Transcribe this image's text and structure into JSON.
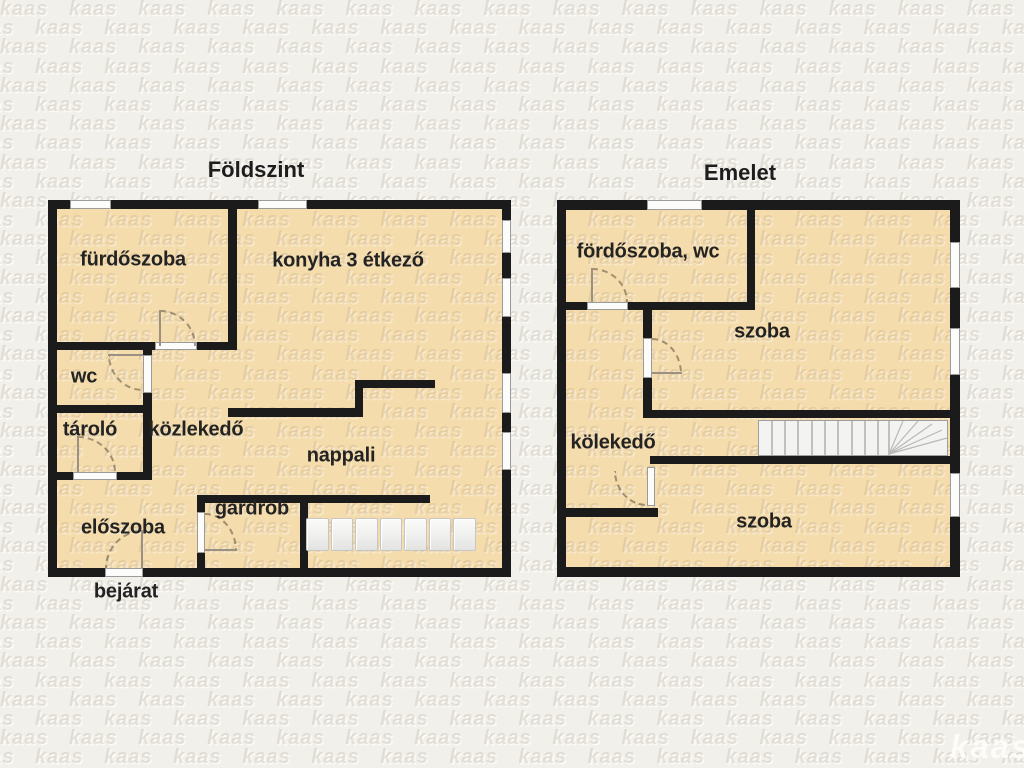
{
  "watermark": {
    "text": "kaas"
  },
  "brand": {
    "logo": "kaas"
  },
  "ground_floor": {
    "title": "Földszint",
    "rooms": {
      "bathroom": "fürdőszoba",
      "kitchen_dining": "konyha 3 étkező",
      "wc": "wc",
      "storage": "tároló",
      "hallway": "közlekedő",
      "living_room": "nappali",
      "wardrobe": "gardrób",
      "entry_hall": "előszoba",
      "entrance": "bejárat"
    }
  },
  "upper_floor": {
    "title": "Emelet",
    "rooms": {
      "bathroom_wc": "fördőszoba, wc",
      "room_upper": "szoba",
      "hallway": "kölekedő",
      "room_lower": "szoba"
    }
  }
}
